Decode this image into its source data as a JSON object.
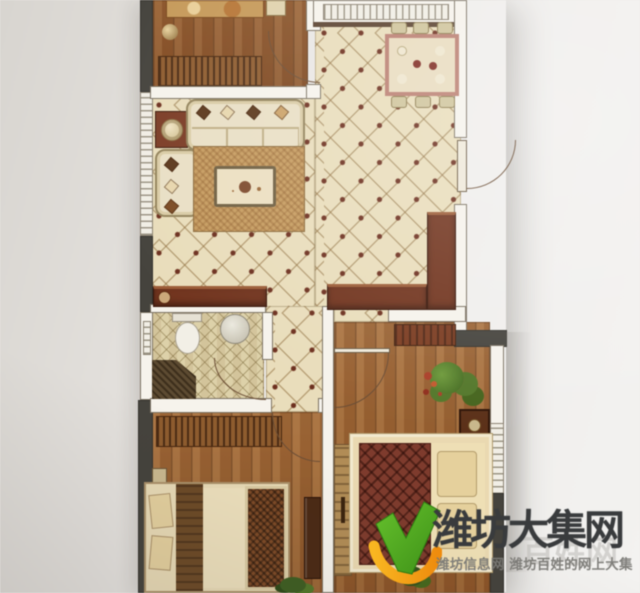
{
  "meta": {
    "width": 640,
    "height": 593,
    "kind": "photographed apartment floor plan with watermark"
  },
  "watermark": {
    "title": "潍坊大集网",
    "subtitle": "潍坊信息网 潍坊百姓的网上大集",
    "ghost_text": "百姓网",
    "colors": {
      "title": "#393b3d",
      "subtitle": "#7a7975",
      "logo_green": "#56ad26",
      "logo_orange": "#f2a01b"
    }
  },
  "floorplan": {
    "palette": {
      "paper": "#efedea",
      "tile_floor": "#e9ddbc",
      "tile_dot": "#6b2f1f",
      "wood_floor": "#9a6232",
      "wall_light": "#f6f3ec",
      "wall_dark": "#45433d",
      "cabinet_wood": "#70341f"
    },
    "rooms": [
      {
        "name": "bedroom-north",
        "floor": "wood",
        "furniture": [
          "bed",
          "nightstand",
          "floor-lamp",
          "wardrobe",
          "door"
        ]
      },
      {
        "name": "dining-area",
        "floor": "tile",
        "furniture": [
          "dining-table",
          "chairs",
          "window"
        ]
      },
      {
        "name": "living-room",
        "floor": "tile",
        "furniture": [
          "sofa",
          "chaise",
          "side-table-lamp",
          "rug",
          "coffee-table",
          "tv-console",
          "window"
        ]
      },
      {
        "name": "entry-hall",
        "floor": "tile",
        "furniture": [
          "entry-door",
          "shoe-cabinet",
          "sideboard"
        ]
      },
      {
        "name": "bathroom",
        "floor": "tile",
        "furniture": [
          "toilet",
          "wash-basin",
          "shower",
          "door"
        ]
      },
      {
        "name": "bedroom-southwest",
        "floor": "wood",
        "furniture": [
          "bed",
          "wardrobe",
          "bench",
          "dresser",
          "plant",
          "door"
        ]
      },
      {
        "name": "bedroom-southeast",
        "floor": "wood",
        "furniture": [
          "bed",
          "pillows",
          "quilt",
          "nightstand",
          "closet",
          "dresser",
          "plant",
          "door"
        ]
      }
    ]
  }
}
